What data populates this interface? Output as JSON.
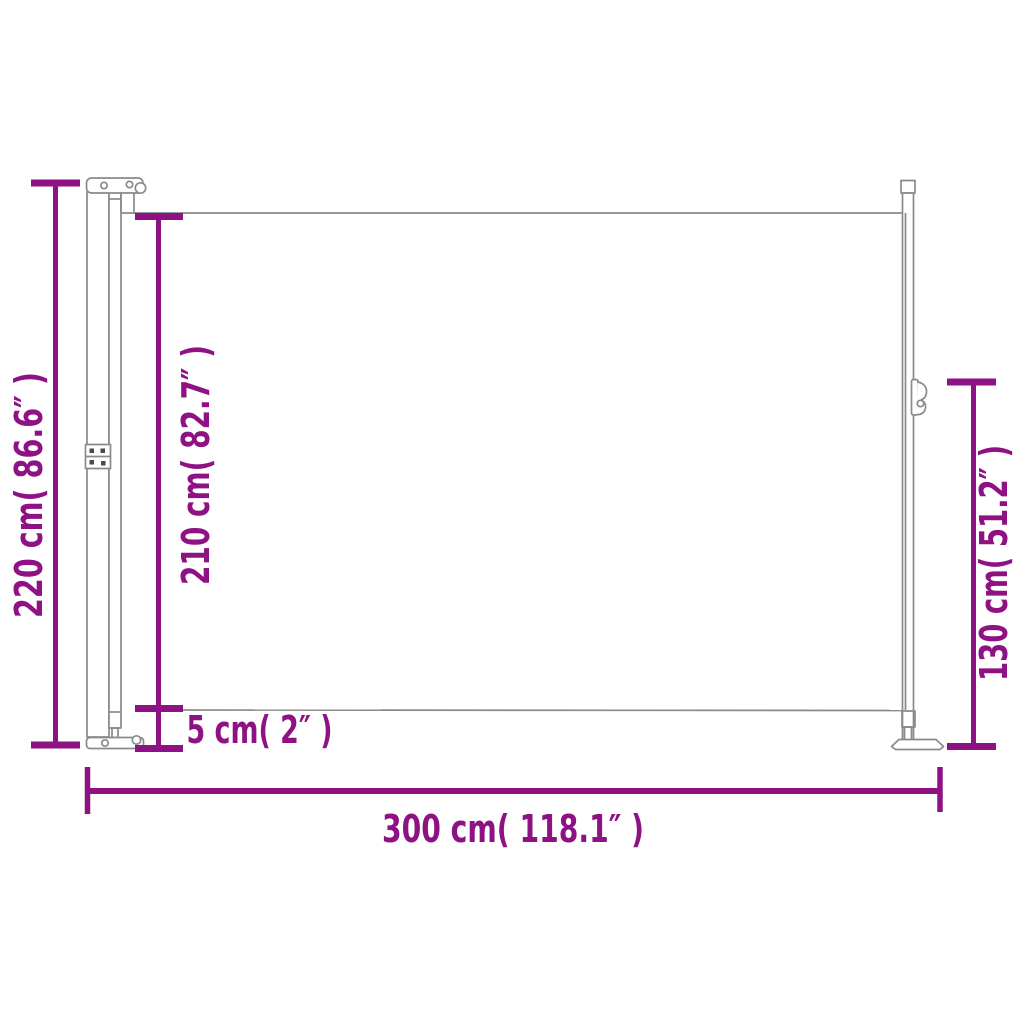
{
  "diagram": {
    "accent_color": "#8E1283",
    "outline_color": "#8A8A8A",
    "dimensions": {
      "overall_height": {
        "cm": 220,
        "inch": 86.6,
        "label": "220 cm( 86.6″ )"
      },
      "fabric_height": {
        "cm": 210,
        "inch": 82.7,
        "label": "210 cm( 82.7″ )"
      },
      "bottom_gap": {
        "cm": 5,
        "inch": 2,
        "label": "5 cm( 2″ )"
      },
      "pole_height": {
        "cm": 130,
        "inch": 51.2,
        "label": "130 cm( 51.2″ )"
      },
      "total_width": {
        "cm": 300,
        "inch": 118.1,
        "label": "300 cm( 118.1″ )"
      }
    }
  }
}
